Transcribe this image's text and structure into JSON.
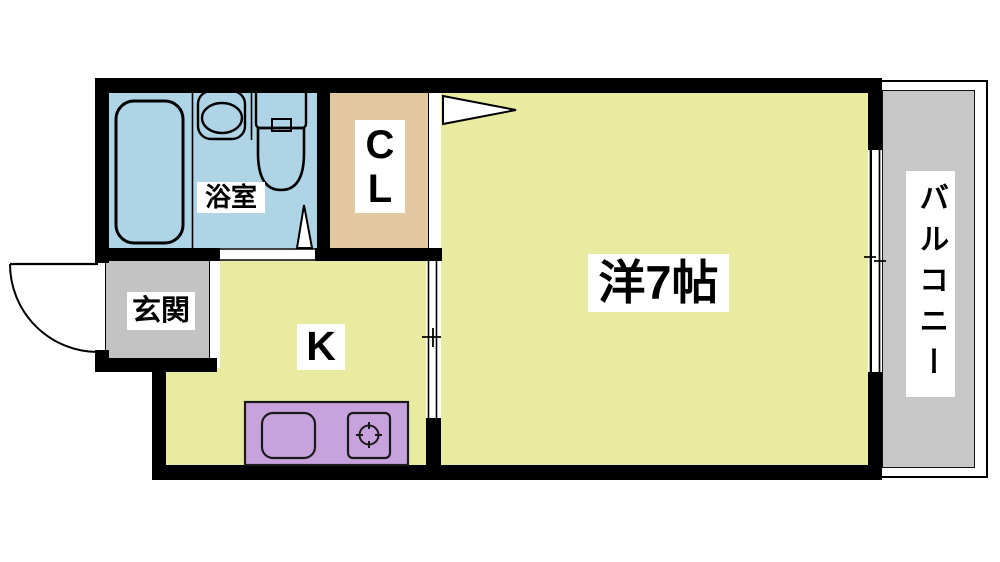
{
  "plan_type": "apartment-floor-plan",
  "rooms": {
    "bathroom": {
      "label": "浴室"
    },
    "closet": {
      "label": "CL"
    },
    "entrance": {
      "label": "玄関"
    },
    "kitchen": {
      "label": "K"
    },
    "main_room": {
      "label": "洋7帖"
    },
    "balcony": {
      "label": "バルコニー"
    }
  },
  "fixtures": [
    "bathtub",
    "washbasin",
    "toilet",
    "hinged-door-swings",
    "sliding-door",
    "sliding-window",
    "kitchen-counter",
    "kitchen-sink",
    "stove-burner"
  ],
  "colors": {
    "wall": "#000000",
    "bathroom_fill": "#afd4e6",
    "closet_fill": "#e2c89e",
    "entrance_fill": "#c3c3c3",
    "room_fill": "#e8eba0",
    "balcony_fill": "#c7c7c7",
    "counter_fill": "#c8a2dc",
    "label_bg": "#ffffff"
  }
}
